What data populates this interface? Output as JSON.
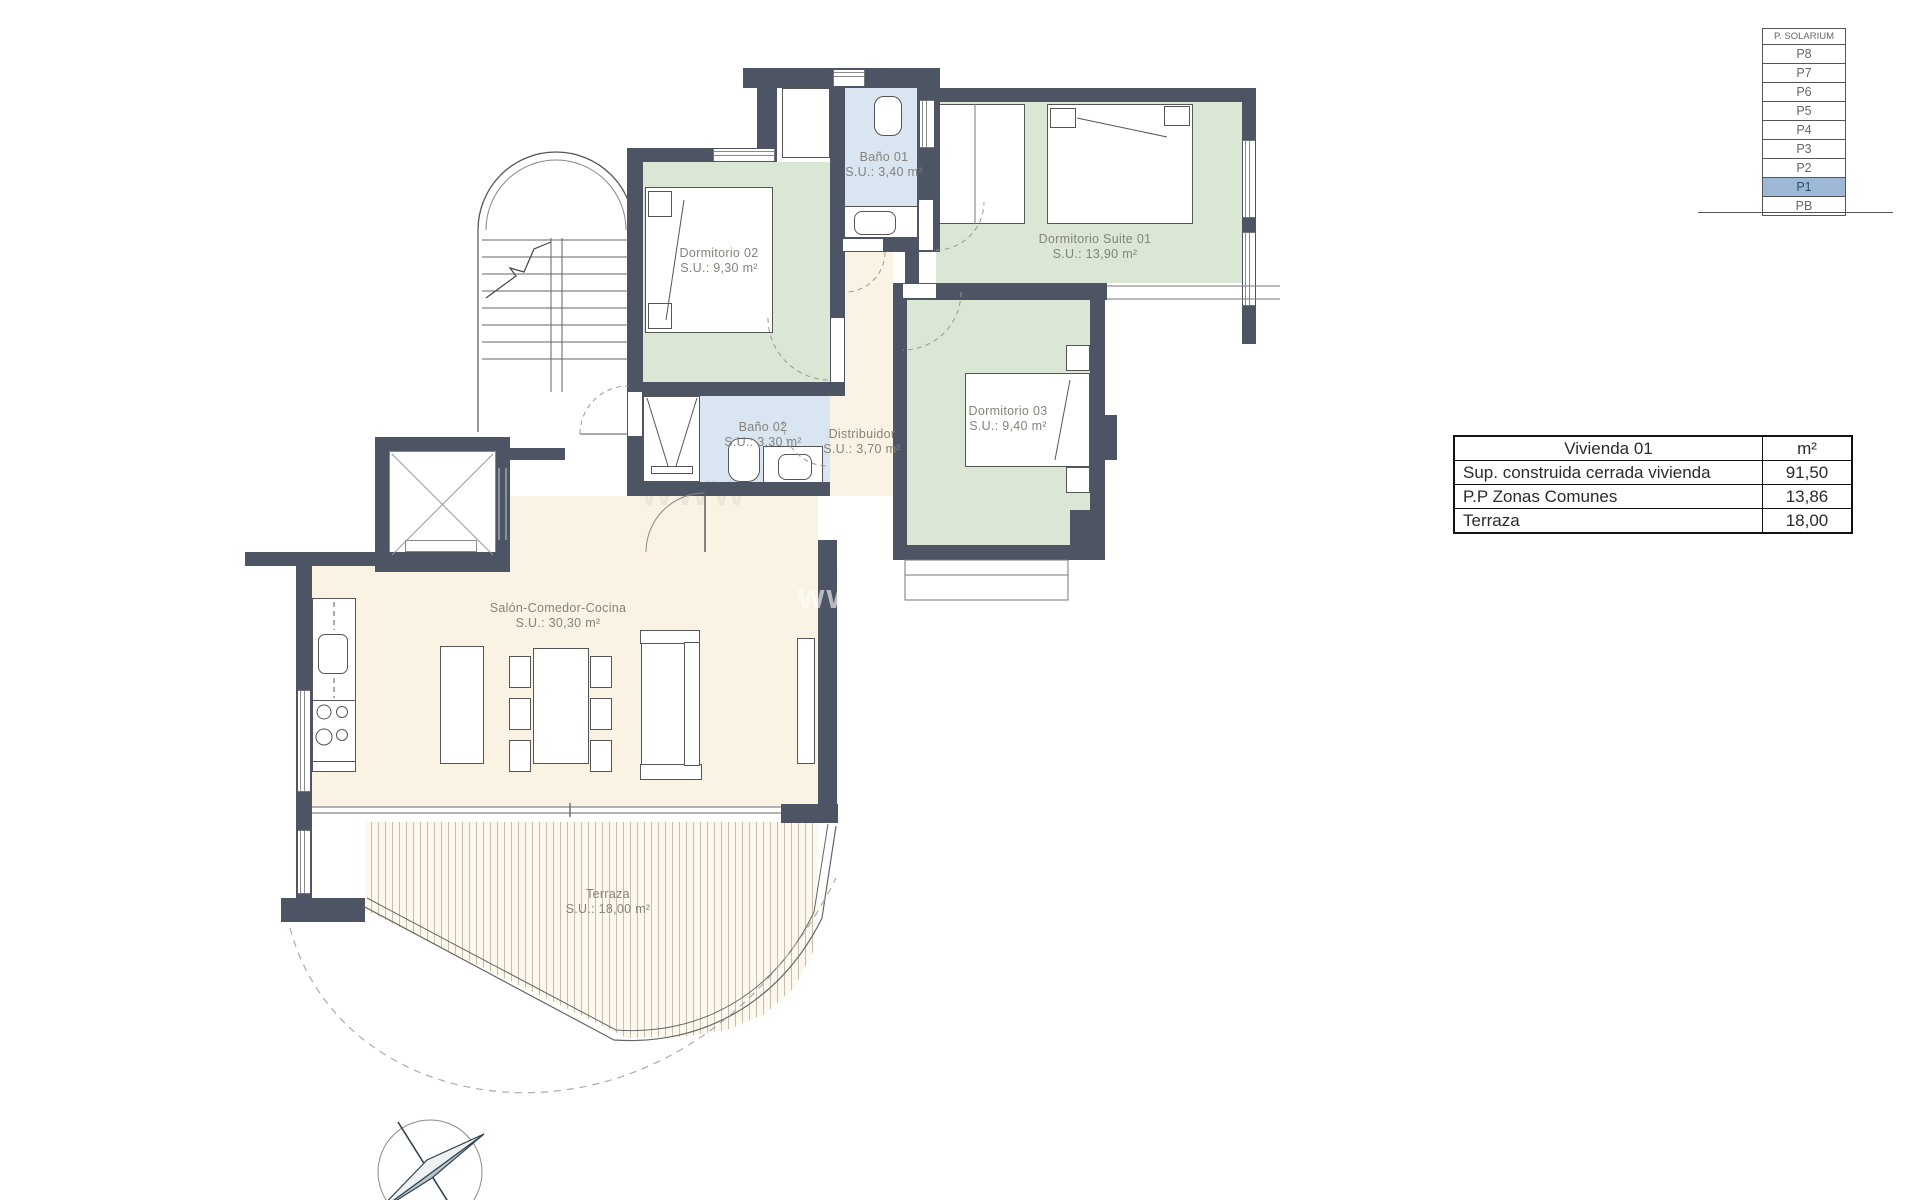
{
  "floor_selector": {
    "title": "P. SOLARIUM",
    "floors": [
      "P8",
      "P7",
      "P6",
      "P5",
      "P4",
      "P3",
      "P2",
      "P1",
      "PB"
    ],
    "selected": "P1",
    "highlight_color": "#9db9d5"
  },
  "area_table": {
    "header": {
      "title": "Vivienda 01",
      "unit": "m²"
    },
    "rows": [
      {
        "label": "Sup. construida cerrada vivienda",
        "value": "91,50"
      },
      {
        "label": "P.P Zonas Comunes",
        "value": "13,86"
      },
      {
        "label": "Terraza",
        "value": "18,00"
      }
    ]
  },
  "rooms": [
    {
      "name": "Dormitorio 02",
      "area": "S.U.: 9,30 m²"
    },
    {
      "name": "Baño 01",
      "area": "S.U.: 3,40 m²"
    },
    {
      "name": "Dormitorio Suite 01",
      "area": "S.U.: 13,90 m²"
    },
    {
      "name": "Baño 02",
      "area": "S.U.: 3,30 m²"
    },
    {
      "name": "Distribuidor",
      "area": "S.U.: 3,70 m²"
    },
    {
      "name": "Dormitorio 03",
      "area": "S.U.: 9,40 m²"
    },
    {
      "name": "Salón-Comedor-Cocina",
      "area": "S.U.: 30,30 m²"
    },
    {
      "name": "Terraza",
      "area": "S.U.: 18,00 m²"
    }
  ],
  "watermark": "www",
  "colors": {
    "wall": "#4d5564",
    "bedroom_fill": "#d9e7d4",
    "bathroom_fill": "#d9e5f1",
    "living_fill": "#faf3e3",
    "selected_floor": "#9db9d5"
  }
}
